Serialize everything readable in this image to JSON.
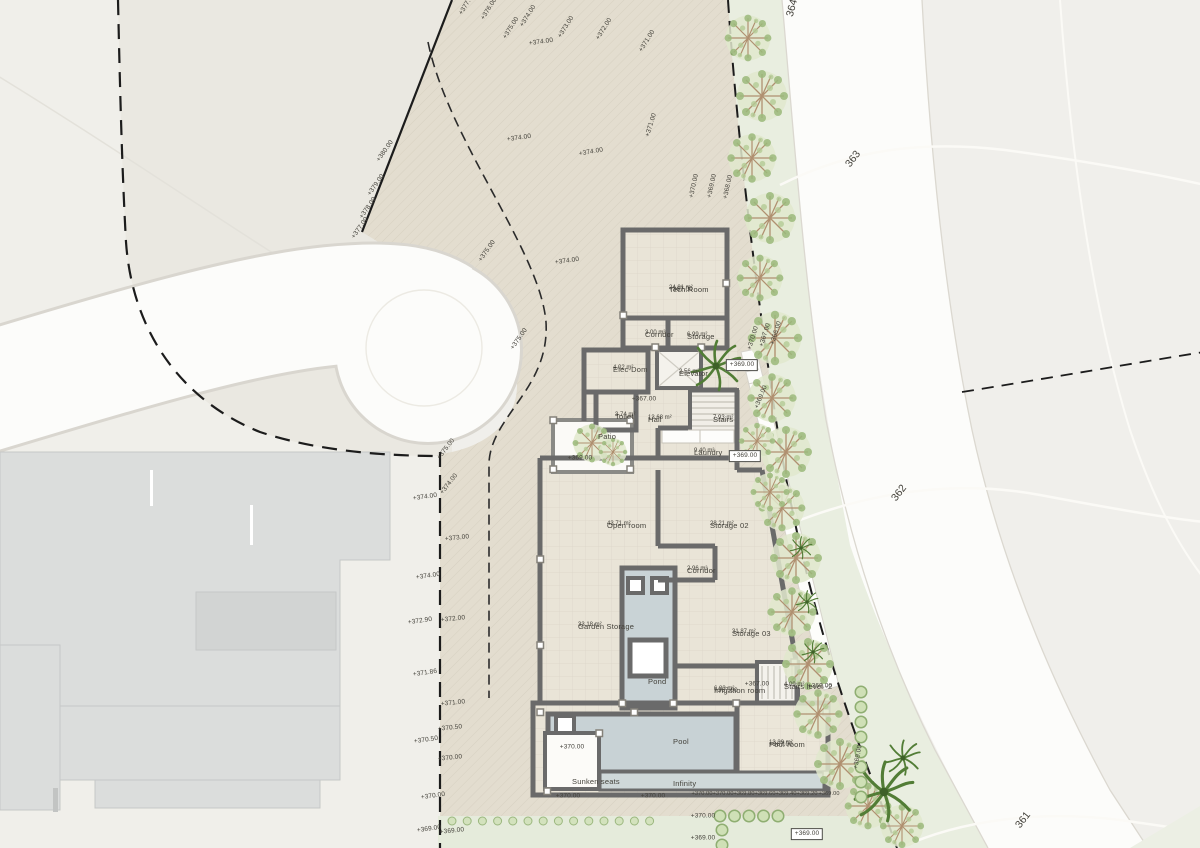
{
  "drawing_type": "architectural-site-plan",
  "palette": {
    "canvas": "#f0efeb",
    "parcel": "#e3ddcf",
    "left_lot": "#eae8e1",
    "road_white": "#fcfcfa",
    "wall_gray": "#6a6a6a",
    "pool_water": "#c8d2d5",
    "vegetation_strip": "#e9eee0",
    "bush_green": "#cfe0b6",
    "palm_green": "#4e7a35",
    "neighbor_building": "#dbdddc",
    "text": "#44423b"
  },
  "plan": {
    "rooms": [
      {
        "name": "Tech.Room",
        "area": "24.81 m²",
        "level": "+367.00",
        "x": 669,
        "y": 285
      },
      {
        "name": "Corridor",
        "area": "3.00 m²",
        "x": 645,
        "y": 330
      },
      {
        "name": "Storage",
        "area": "6.99 m²",
        "x": 687,
        "y": 332
      },
      {
        "name": "Elec-Dom",
        "area": "4.02 m²",
        "x": 613,
        "y": 365
      },
      {
        "name": "Elevator",
        "area": "2.56 m²",
        "x": 679,
        "y": 369
      },
      {
        "name": "Toilet",
        "area": "3.74 m²",
        "x": 615,
        "y": 412
      },
      {
        "name": "Hall",
        "area": "13.68 m²",
        "x": 648,
        "y": 415
      },
      {
        "name": "Stairs",
        "area": "7.93 m²",
        "x": 713,
        "y": 415
      },
      {
        "name": "Laundry",
        "area": "9.40 m²",
        "x": 694,
        "y": 448
      },
      {
        "name": "Patio",
        "x": 598,
        "y": 432
      },
      {
        "name": "Open room",
        "area": "43.71 m²",
        "x": 607,
        "y": 521
      },
      {
        "name": "Storage 02",
        "area": "28.21 m²",
        "x": 710,
        "y": 521
      },
      {
        "name": "Corridor",
        "area": "2.96 m²",
        "x": 687,
        "y": 566
      },
      {
        "name": "Garden Storage",
        "area": "33.18 m²",
        "x": 578,
        "y": 622
      },
      {
        "name": "Storage 03",
        "area": "31.87 m²",
        "x": 732,
        "y": 629
      },
      {
        "name": "Pond",
        "x": 648,
        "y": 677
      },
      {
        "name": "Irrigation room",
        "area": "6.83 m²",
        "level": "+367.00",
        "x": 714,
        "y": 686
      },
      {
        "name": "Stairs level -2",
        "area": "4.09 m²",
        "x": 784,
        "y": 682
      },
      {
        "name": "Pool",
        "x": 673,
        "y": 737
      },
      {
        "name": "Pool room",
        "area": "13.39 m²",
        "level": "+367.00",
        "x": 769,
        "y": 740
      },
      {
        "name": "Sunken seats",
        "x": 572,
        "y": 777
      },
      {
        "name": "Infinity",
        "x": 673,
        "y": 779
      }
    ],
    "elevation_labels": [
      {
        "t": "+377.00",
        "x": 467,
        "y": 4,
        "r": -58
      },
      {
        "t": "+376.00",
        "x": 489,
        "y": 9,
        "r": -58
      },
      {
        "t": "+375.00",
        "x": 511,
        "y": 28,
        "r": -58
      },
      {
        "t": "+374.00",
        "x": 528,
        "y": 16,
        "r": -58
      },
      {
        "t": "+374.00",
        "x": 541,
        "y": 42,
        "r": -8
      },
      {
        "t": "+373.00",
        "x": 566,
        "y": 27,
        "r": -58
      },
      {
        "t": "+372.00",
        "x": 604,
        "y": 29,
        "r": -58
      },
      {
        "t": "+371.00",
        "x": 647,
        "y": 41,
        "r": -58
      },
      {
        "t": "+374.00",
        "x": 519,
        "y": 138,
        "r": -8
      },
      {
        "t": "+374.00",
        "x": 591,
        "y": 152,
        "r": -10
      },
      {
        "t": "+371.00",
        "x": 651,
        "y": 125,
        "r": -73
      },
      {
        "t": "+370.00",
        "x": 694,
        "y": 186,
        "r": -78
      },
      {
        "t": "+369.00",
        "x": 712,
        "y": 186,
        "r": -78
      },
      {
        "t": "+368.00",
        "x": 728,
        "y": 187,
        "r": -78
      },
      {
        "t": "+380.00",
        "x": 385,
        "y": 151,
        "r": -55
      },
      {
        "t": "+379.00",
        "x": 376,
        "y": 185,
        "r": -55
      },
      {
        "t": "+378.00",
        "x": 368,
        "y": 208,
        "r": -55
      },
      {
        "t": "+377.00",
        "x": 360,
        "y": 228,
        "r": -55
      },
      {
        "t": "+375.00",
        "x": 487,
        "y": 251,
        "r": -55
      },
      {
        "t": "+374.00",
        "x": 567,
        "y": 261,
        "r": -8
      },
      {
        "t": "+375.00",
        "x": 519,
        "y": 339,
        "r": -55
      },
      {
        "t": "+375.00",
        "x": 446,
        "y": 449,
        "r": -52
      },
      {
        "t": "+374.00",
        "x": 449,
        "y": 484,
        "r": -52
      },
      {
        "t": "+374.00",
        "x": 425,
        "y": 497,
        "r": -8
      },
      {
        "t": "+373.00",
        "x": 457,
        "y": 538,
        "r": -6
      },
      {
        "t": "+374.00",
        "x": 428,
        "y": 576,
        "r": -8
      },
      {
        "t": "+372.90",
        "x": 420,
        "y": 621,
        "r": -8
      },
      {
        "t": "+372.00",
        "x": 453,
        "y": 619,
        "r": -6
      },
      {
        "t": "+371.86",
        "x": 425,
        "y": 673,
        "r": -8
      },
      {
        "t": "+371.00",
        "x": 453,
        "y": 703,
        "r": -6
      },
      {
        "t": "+370.50",
        "x": 450,
        "y": 728,
        "r": -6
      },
      {
        "t": "+370.50",
        "x": 426,
        "y": 740,
        "r": -8
      },
      {
        "t": "+370.00",
        "x": 450,
        "y": 758,
        "r": -6
      },
      {
        "t": "+370.00",
        "x": 433,
        "y": 796,
        "r": -8
      },
      {
        "t": "+369.00",
        "x": 429,
        "y": 829,
        "r": -8
      },
      {
        "t": "+369.00",
        "x": 452,
        "y": 831,
        "r": -6
      },
      {
        "t": "+370.00",
        "x": 753,
        "y": 338,
        "r": -73
      },
      {
        "t": "+367.00",
        "x": 765,
        "y": 335,
        "r": -73
      },
      {
        "t": "+366.00",
        "x": 776,
        "y": 333,
        "r": -73
      },
      {
        "t": "+369.00",
        "x": 742,
        "y": 365,
        "r": 0,
        "boxed": true
      },
      {
        "t": "+369.00",
        "x": 761,
        "y": 397,
        "r": -68
      },
      {
        "t": "+369.00",
        "x": 745,
        "y": 456,
        "r": 0,
        "boxed": true
      },
      {
        "t": "+369.00",
        "x": 580,
        "y": 458,
        "r": 0
      },
      {
        "t": "+367.00",
        "x": 644,
        "y": 399,
        "r": 0
      },
      {
        "t": "+367.00",
        "x": 757,
        "y": 684,
        "r": 0
      },
      {
        "t": "+369.00",
        "x": 820,
        "y": 686,
        "r": 0
      },
      {
        "t": "+369.00",
        "x": 858,
        "y": 757,
        "r": -80
      },
      {
        "t": "+370.00",
        "x": 568,
        "y": 796,
        "r": 0
      },
      {
        "t": "+370.00",
        "x": 653,
        "y": 796,
        "r": 0
      },
      {
        "t": "+370.00",
        "x": 702,
        "y": 794,
        "r": 0,
        "s": true
      },
      {
        "t": "+370.00",
        "x": 723,
        "y": 794,
        "r": 0,
        "s": true
      },
      {
        "t": "+369.80",
        "x": 744,
        "y": 794,
        "r": 0,
        "s": true
      },
      {
        "t": "+369.60",
        "x": 765,
        "y": 794,
        "r": 0,
        "s": true
      },
      {
        "t": "+369.40",
        "x": 786,
        "y": 794,
        "r": 0,
        "s": true
      },
      {
        "t": "+369.20",
        "x": 807,
        "y": 794,
        "r": 0,
        "s": true
      },
      {
        "t": "+369.00",
        "x": 829,
        "y": 794,
        "r": 0,
        "s": true
      },
      {
        "t": "+370.00",
        "x": 703,
        "y": 816,
        "r": 0
      },
      {
        "t": "+369.00",
        "x": 703,
        "y": 838,
        "r": 0
      },
      {
        "t": "+369.00",
        "x": 807,
        "y": 834,
        "r": 0,
        "boxed": true
      },
      {
        "t": "+370.00",
        "x": 572,
        "y": 747,
        "r": 0
      }
    ],
    "contour_labels": [
      {
        "t": "364",
        "x": 792,
        "y": 8,
        "r": -75
      },
      {
        "t": "363",
        "x": 853,
        "y": 159,
        "r": -52
      },
      {
        "t": "362",
        "x": 899,
        "y": 493,
        "r": -52
      },
      {
        "t": "361",
        "x": 1023,
        "y": 820,
        "r": -52
      }
    ]
  }
}
